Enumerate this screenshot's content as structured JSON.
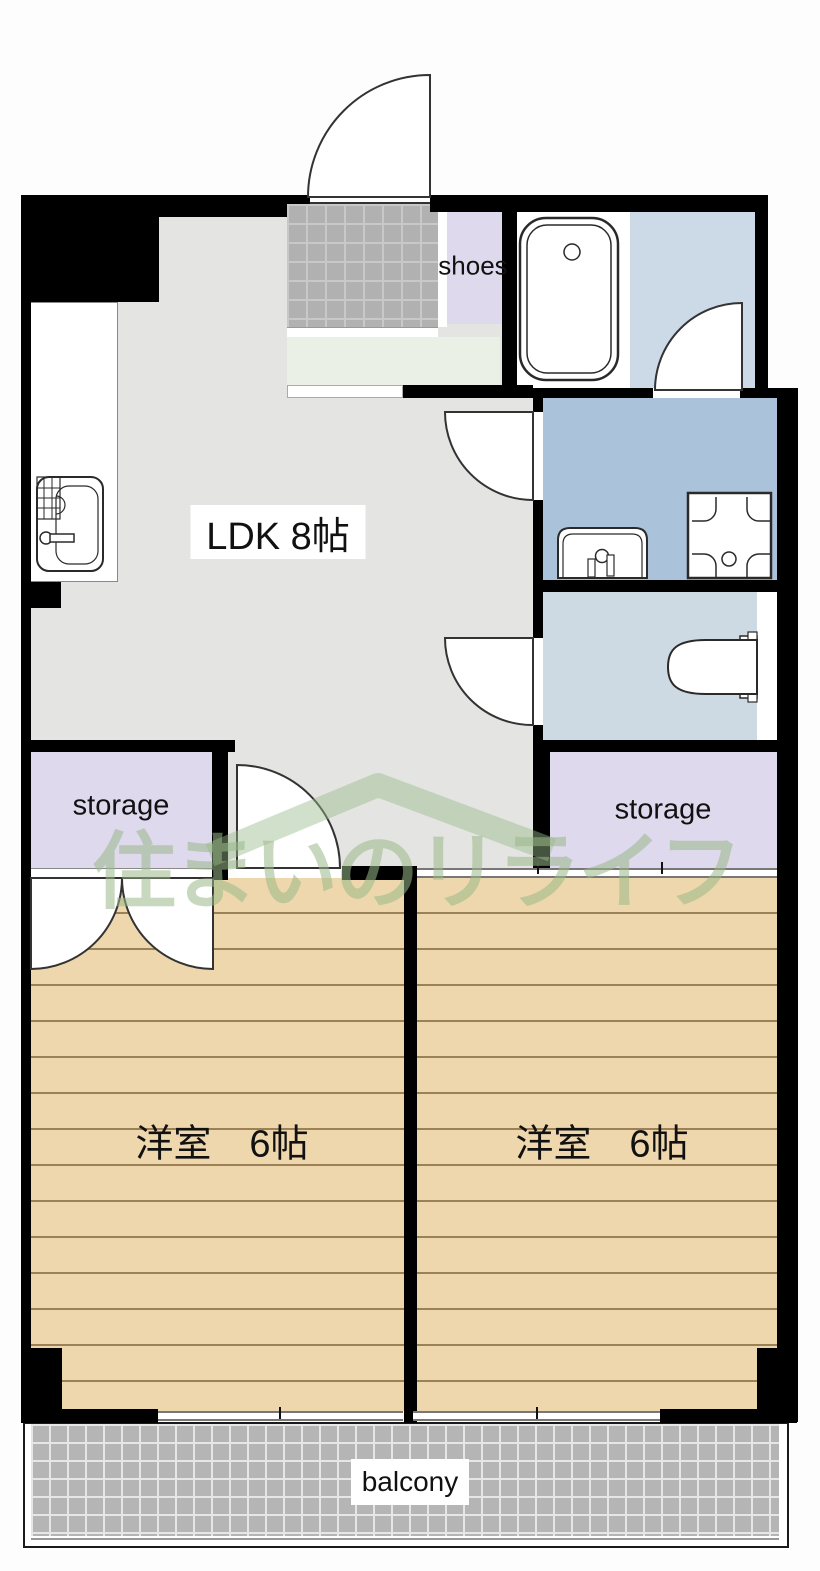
{
  "floor_plan": {
    "labels": {
      "shoes": "shoes",
      "ldk": "LDK 8帖",
      "storage_left": "storage",
      "storage_right": "storage",
      "bedroom_left": "洋室　6帖",
      "bedroom_right": "洋室　6帖",
      "balcony": "balcony"
    },
    "watermark": {
      "text": "住まいのリライフ",
      "color": "#9aba89"
    },
    "rooms": [
      {
        "name": "LDK",
        "size_label": "8帖"
      },
      {
        "name": "洋室 (left)",
        "size_label": "6帖"
      },
      {
        "name": "洋室 (right)",
        "size_label": "6帖"
      },
      {
        "name": "storage (left)"
      },
      {
        "name": "storage (right)"
      },
      {
        "name": "balcony"
      }
    ],
    "fixtures": [
      {
        "name": "bathtub"
      },
      {
        "name": "kitchen-sink"
      },
      {
        "name": "vanity-sink"
      },
      {
        "name": "washing-machine-pan"
      },
      {
        "name": "toilet"
      }
    ],
    "colors": {
      "wall": "#000000",
      "ldk_floor": "#e4e4e2",
      "bedroom_floor": "#eed7ad",
      "bedroom_plank_line": "#9c8158",
      "storage_floor": "#ded9ed",
      "bathroom_floor": "#ccdae7",
      "washroom_floor": "#abc3da",
      "toilet_floor": "#cdd9e3",
      "hall_floor": "#eaf0e5",
      "entrance_tile": "#b1b1b1",
      "balcony_tile": "#b5b5b5",
      "watermark": "#9aba89"
    }
  }
}
